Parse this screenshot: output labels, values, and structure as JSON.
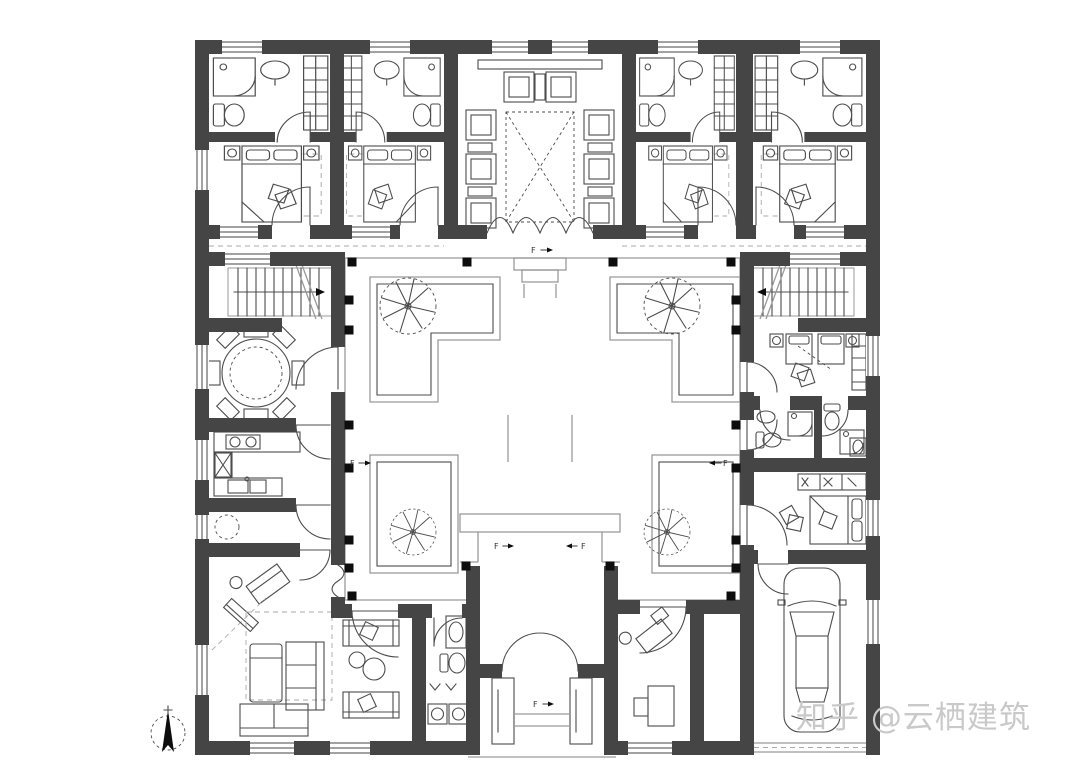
{
  "page": {
    "background": "#ffffff"
  },
  "watermark": {
    "text": "知乎 @云栖建筑"
  },
  "plan": {
    "level_marker": "F"
  },
  "colors": {
    "wall": "#454545",
    "line": "#4c4c4c",
    "paving": "#9a9a9a",
    "light": "#aaaaaa",
    "column": "#0d0d0d",
    "marker": "#333333",
    "watermark": "#c9c9c9",
    "bg": "#ffffff"
  }
}
